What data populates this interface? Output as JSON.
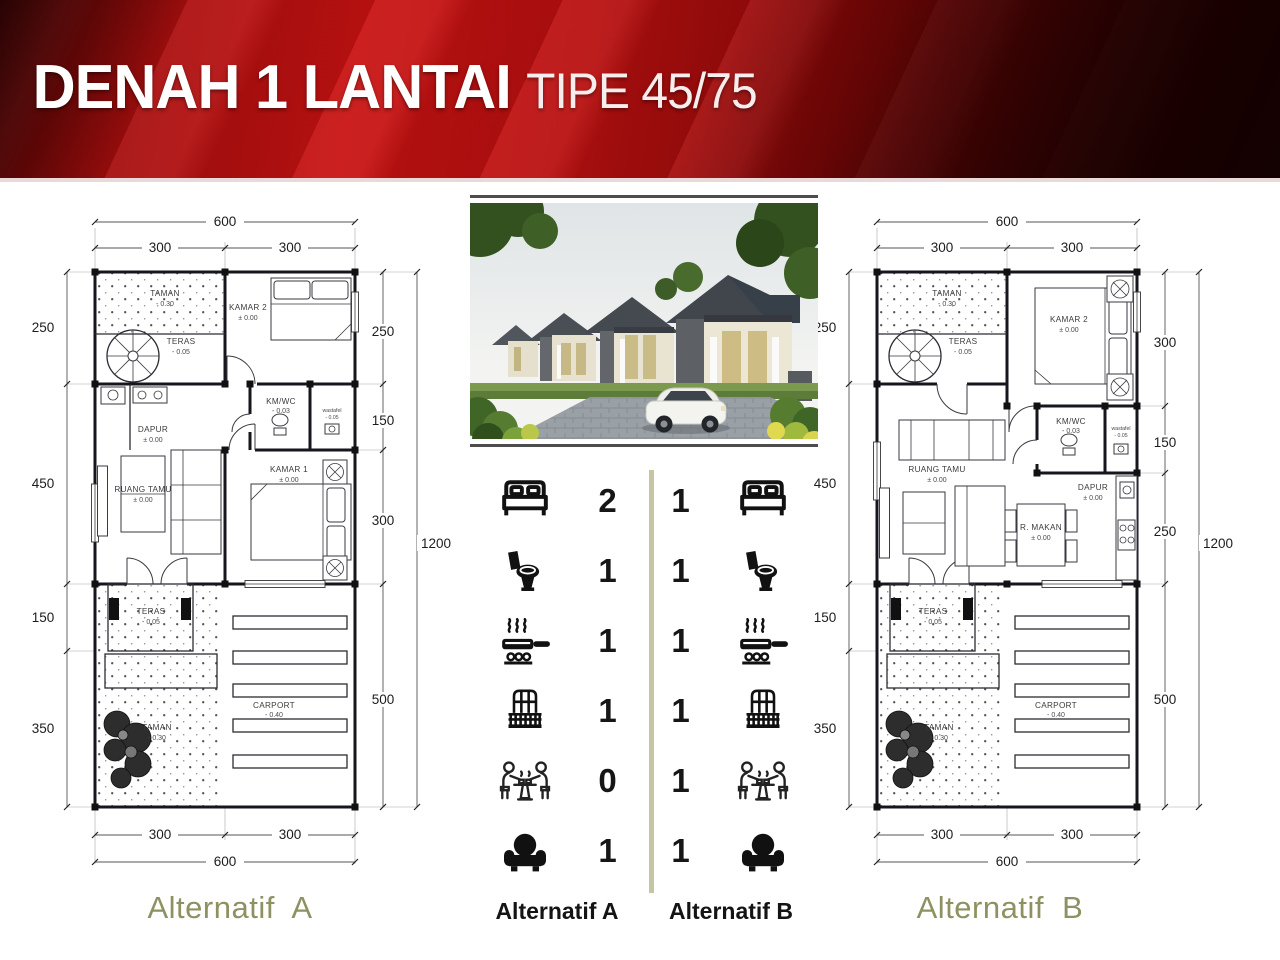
{
  "header": {
    "title": "DENAH 1 LANTAI",
    "subtitle": "TIPE 45/75"
  },
  "comparison": {
    "label_a": "Alternatif A",
    "label_b": "Alternatif B",
    "rows": [
      {
        "feature": "bedroom",
        "a": "2",
        "b": "1"
      },
      {
        "feature": "bathroom",
        "a": "1",
        "b": "1"
      },
      {
        "feature": "kitchen",
        "a": "1",
        "b": "1"
      },
      {
        "feature": "balcony",
        "a": "1",
        "b": "1"
      },
      {
        "feature": "dining",
        "a": "0",
        "b": "1"
      },
      {
        "feature": "living",
        "a": "1",
        "b": "1"
      }
    ]
  },
  "plan_a": {
    "label": "Alternatif  A",
    "dims": {
      "total_width": "600",
      "half_width_1": "300",
      "half_width_2": "300",
      "total_height": "1200",
      "left": [
        "250",
        "450",
        "150",
        "350"
      ],
      "right": [
        "250",
        "150",
        "300",
        "500"
      ]
    },
    "rooms": {
      "taman_top": {
        "name": "TAMAN",
        "level": "- 0.30"
      },
      "teras_top": {
        "name": "TERAS",
        "level": "- 0.05"
      },
      "kamar2": {
        "name": "KAMAR 2",
        "level": "± 0.00"
      },
      "kmwc": {
        "name": "KM/WC",
        "level": "- 0.03"
      },
      "wastafel": {
        "name": "wastafel",
        "level": "- 0.05"
      },
      "dapur": {
        "name": "DAPUR",
        "level": "± 0.00"
      },
      "ruang_tamu": {
        "name": "RUANG TAMU",
        "level": "± 0.00"
      },
      "kamar1": {
        "name": "KAMAR 1",
        "level": "± 0.00"
      },
      "teras_bottom": {
        "name": "TERAS",
        "level": "- 0.05"
      },
      "taman_bottom": {
        "name": "TAMAN",
        "level": "- 0.30"
      },
      "carport": {
        "name": "CARPORT",
        "level": "- 0.40"
      }
    }
  },
  "plan_b": {
    "label": "Alternatif  B",
    "dims": {
      "total_width": "600",
      "half_width_1": "300",
      "half_width_2": "300",
      "total_height": "1200",
      "left": [
        "250",
        "450",
        "150",
        "350"
      ],
      "right": [
        "300",
        "150",
        "250",
        "500"
      ]
    },
    "rooms": {
      "taman_top": {
        "name": "TAMAN",
        "level": "- 0.30"
      },
      "teras_top": {
        "name": "TERAS",
        "level": "- 0.05"
      },
      "kamar2": {
        "name": "KAMAR 2",
        "level": "± 0.00"
      },
      "kmwc": {
        "name": "KM/WC",
        "level": "- 0.03"
      },
      "wastafel": {
        "name": "wastafel",
        "level": "- 0.05"
      },
      "ruang_tamu": {
        "name": "RUANG TAMU",
        "level": "± 0.00"
      },
      "r_makan": {
        "name": "R. MAKAN",
        "level": "± 0.00"
      },
      "dapur": {
        "name": "DAPUR",
        "level": "± 0.00"
      },
      "teras_bottom": {
        "name": "TERAS",
        "level": "- 0.05"
      },
      "taman_bottom": {
        "name": "TAMAN",
        "level": "- 0.30"
      },
      "carport": {
        "name": "CARPORT",
        "level": "- 0.40"
      }
    }
  }
}
